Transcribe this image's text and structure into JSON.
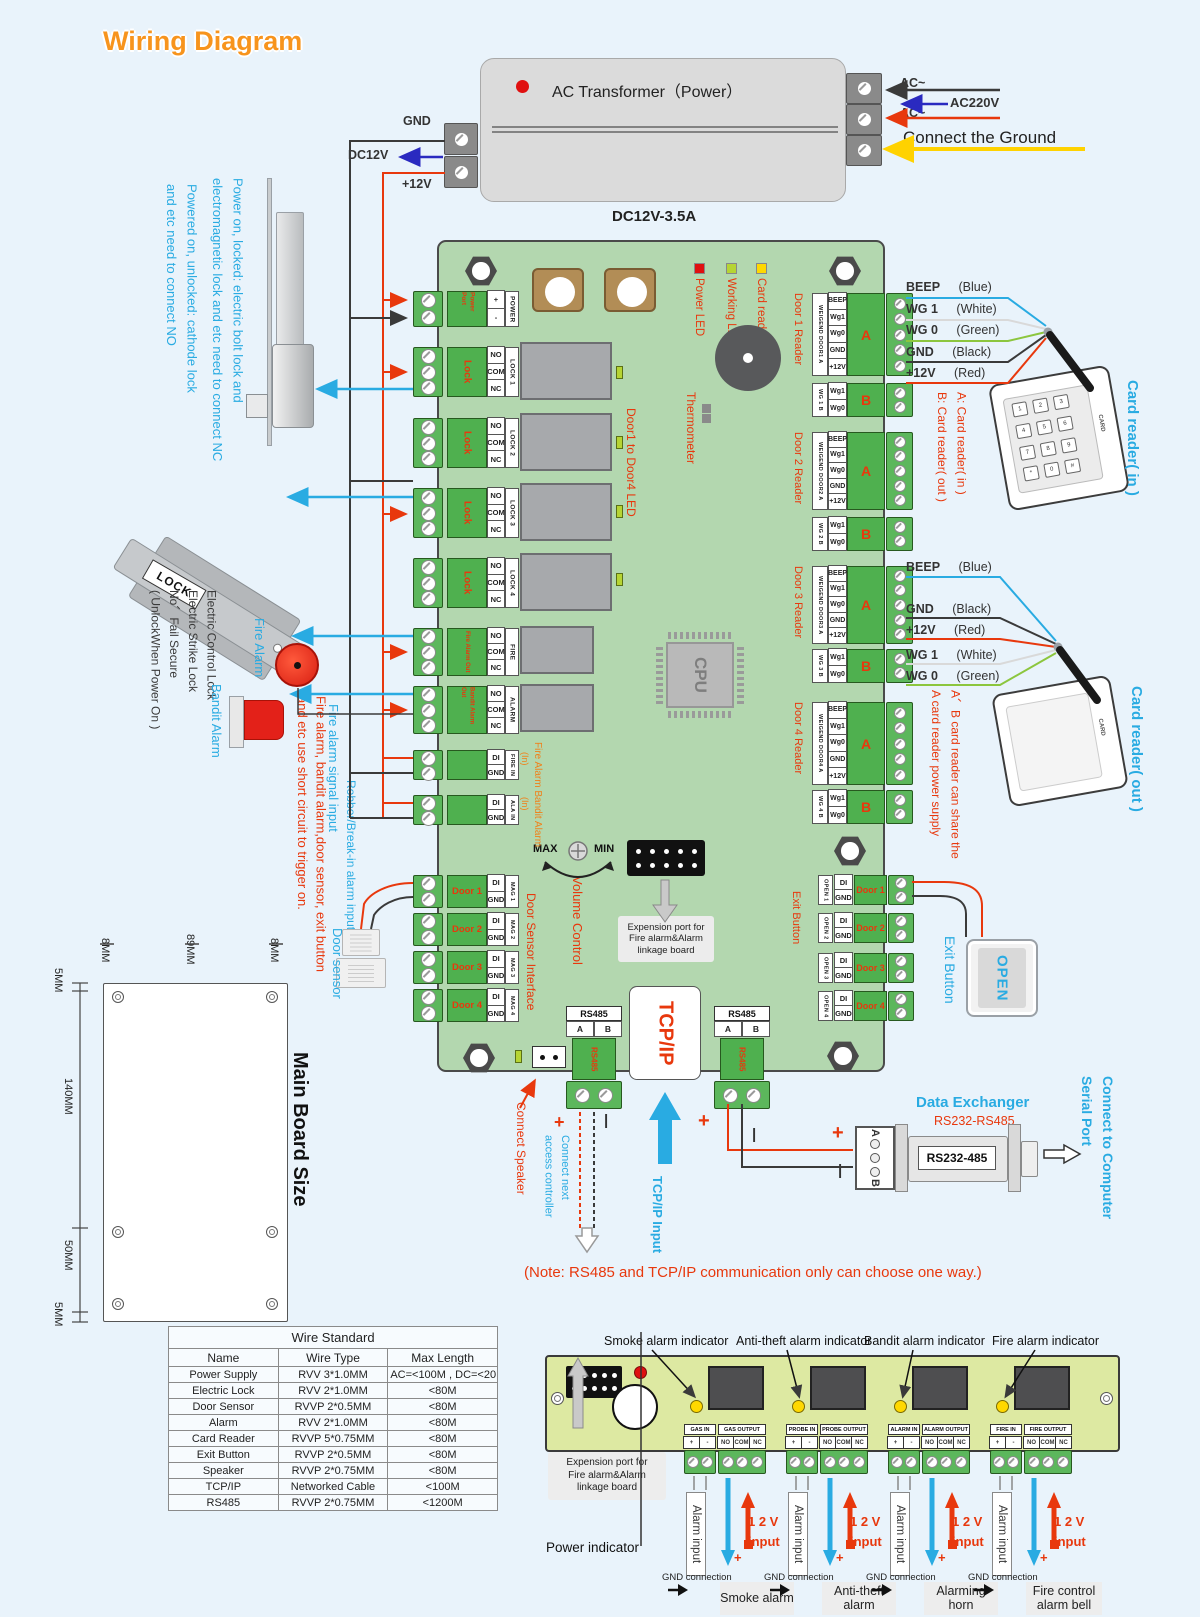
{
  "title": "Wiring Diagram",
  "transformer": {
    "label": "AC Transformer（Power）",
    "dc": "DC12V-3.5A",
    "gnd": "GND",
    "dc12v": "DC12V",
    "p12v": "+12V",
    "ac1": "AC~",
    "ac220": "AC220V",
    "ac2": "AC~",
    "ground": "Connect the Ground"
  },
  "left": {
    "nc_note": [
      "Power on, locked: electric bolt lock and",
      "electromagnetic lock and etc need to connect NC"
    ],
    "no_note": [
      "Powered on, unlocked: cathode lock",
      "and etc need to connect NO"
    ],
    "lock_word": "LOCK",
    "strike_note": [
      "Electric Control Lock",
      "Electric Strike Lock",
      "No、Fail Secure",
      "( UnlockWhen Power On )"
    ],
    "fire_alarm": "Fire Alarm",
    "bandit_alarm": "Bandit Alarm",
    "fire_signal": "Fire alarm signal input",
    "robber": "Robber/Break-in alarm input",
    "trigger_note": [
      "Fire alarm, bandit alarm,door sensor, exit button",
      "and etc use short circuit to trigger on."
    ],
    "door_sensor": "Door sensor"
  },
  "board": {
    "power": {
      "name": [
        "Power",
        "Port"
      ],
      "pins": [
        "+",
        "-"
      ],
      "tag": "POWER"
    },
    "nocomnc": [
      "NO",
      "COM",
      "NC"
    ],
    "digin": [
      "DI",
      "GND"
    ],
    "locks": [
      {
        "name": "Lock",
        "tag": "LOCK 1"
      },
      {
        "name": "Lock",
        "tag": "LOCK 2"
      },
      {
        "name": "Lock",
        "tag": "LOCK 3"
      },
      {
        "name": "Lock",
        "tag": "LOCK 4"
      }
    ],
    "fire_out": {
      "name": [
        "Fire Alarm",
        "Out"
      ],
      "tag": "FIRE"
    },
    "bandit_out": {
      "name": [
        "Bandit Alarm",
        "Out"
      ],
      "tag": "ALARM"
    },
    "fire_in_tag": "FIRE IN",
    "ala_in_tag": "ALA IN",
    "in_note": "(In)",
    "in_label": "Fire Alarm Bandit Alarm",
    "doors": [
      {
        "name": "Door 1",
        "tag": "MAG 1"
      },
      {
        "name": "Door 2",
        "tag": "MAG 2"
      },
      {
        "name": "Door 3",
        "tag": "MAG 3"
      },
      {
        "name": "Door 4",
        "tag": "MAG 4"
      }
    ],
    "door_iface": "Door Sensor Interface",
    "leds": [
      "Power LED",
      "Working LED",
      "Card reader LED"
    ],
    "thermometer": "Thermometer",
    "door_led": "Door1 to Door4 LED",
    "cpu": "CPU",
    "volume": {
      "max": "MAX",
      "min": "MIN",
      "label": "Volume Control"
    },
    "expansion": [
      "Expension port for",
      "Fire alarm&Alarm",
      "linkage board"
    ],
    "reader_a_pins": [
      "BEEP",
      "Wg1",
      "Wg0",
      "GND",
      "+12V"
    ],
    "reader_b_pins": [
      "Wg1",
      "Wg0"
    ],
    "readers": [
      {
        "name": "Door 1 Reader",
        "a_tag": "WEIGEND DOOR1 A",
        "b_tag": "WG 1 B",
        "a": "A",
        "b": "B"
      },
      {
        "name": "Door 2 Reader",
        "a_tag": "WEIGEND DOOR2 A",
        "b_tag": "WG 2 B",
        "a": "A",
        "b": "B"
      },
      {
        "name": "Door 3 Reader",
        "a_tag": "WEIGEND DOOR3 A",
        "b_tag": "WG 3 B",
        "a": "A",
        "b": "B"
      },
      {
        "name": "Door 4 Reader",
        "a_tag": "WEIGEND DOOR4 A",
        "b_tag": "WG 4 B",
        "a": "A",
        "b": "B"
      }
    ],
    "exit_label": "Exit Button",
    "exits": [
      {
        "tag": "OPEN 1",
        "name": "Door 1"
      },
      {
        "tag": "OPEN 2",
        "name": "Door 2"
      },
      {
        "tag": "OPEN 3",
        "name": "Door 3"
      },
      {
        "tag": "OPEN 4",
        "name": "Door 4"
      }
    ],
    "rs485": {
      "title": "RS485",
      "a": "A",
      "b": "B",
      "vert": "RS485"
    },
    "tcpip": "TCP/IP"
  },
  "right": {
    "wires1": [
      {
        "n": "BEEP",
        "c": "(Blue)"
      },
      {
        "n": "WG 1",
        "c": "(White)"
      },
      {
        "n": "WG 0",
        "c": "(Green)"
      },
      {
        "n": "GND",
        "c": "(Black)"
      },
      {
        "n": "+12V",
        "c": "(Red)"
      }
    ],
    "wires2": [
      {
        "n": "BEEP",
        "c": "(Blue)"
      },
      {
        "n": "GND",
        "c": "(Black)"
      },
      {
        "n": "+12V",
        "c": "(Red)"
      },
      {
        "n": "WG 1",
        "c": "(White)"
      },
      {
        "n": "WG 0",
        "c": "(Green)"
      }
    ],
    "ab_note": [
      "A: Card reader( in )",
      "B: Card reader( out )"
    ],
    "share_note": [
      "A、B card reader can share the",
      "A card reader power supply"
    ],
    "reader_in": "Card reader( in )",
    "reader_out": "Card reader( out )",
    "card": "CARD",
    "keys": [
      "1",
      "2",
      "3",
      "4",
      "5",
      "6",
      "7",
      "8",
      "9",
      "*",
      "0",
      "#"
    ],
    "open": "OPEN",
    "exit_button": "Exit Button"
  },
  "mid": {
    "connect_speaker": "Connect Speaker",
    "connect_next": [
      "Connect next",
      "access controller"
    ],
    "tcpip_input": "TCP/IP Input",
    "plus": "+",
    "minus": "|",
    "note": "(Note: RS485 and TCP/IP communication only can choose one way.)",
    "exchanger": {
      "title": "Data Exchanger",
      "sub": "RS232-RS485",
      "label": "RS232-485",
      "a": "A",
      "b": "B"
    },
    "connect_computer": [
      "Connect to Computer",
      "Serial Port"
    ]
  },
  "size": {
    "label": "Main Board Size",
    "top": [
      "8MM",
      "89MM",
      "8MM"
    ],
    "left": [
      "5MM",
      "140MM",
      "50MM",
      "5MM"
    ]
  },
  "table": {
    "title": "Wire Standard",
    "headers": [
      "Name",
      "Wire Type",
      "Max Length"
    ],
    "rows": [
      [
        "Power Supply",
        "RVV 3*1.0MM",
        "AC=<100M , DC=<20M"
      ],
      [
        "Electric Lock",
        "RVV 2*1.0MM",
        "<80M"
      ],
      [
        "Door Sensor",
        "RVVP 2*0.5MM",
        "<80M"
      ],
      [
        "Alarm",
        "RVV 2*1.0MM",
        "<80M"
      ],
      [
        "Card Reader",
        "RVVP 5*0.75MM",
        "<80M"
      ],
      [
        "Exit Button",
        "RVVP 2*0.5MM",
        "<80M"
      ],
      [
        "Speaker",
        "RVVP 2*0.75MM",
        "<80M"
      ],
      [
        "TCP/IP",
        "Networked Cable",
        "<100M"
      ],
      [
        "RS485",
        "RVVP 2*0.75MM",
        "<1200M"
      ]
    ]
  },
  "linkage": {
    "indicators": [
      "Smoke alarm indicator",
      "Anti-theft alarm indicator",
      "Bandit alarm indicator",
      "Fire alarm indicator"
    ],
    "in_pins": [
      "+",
      "-"
    ],
    "out_pins": [
      "NO",
      "COM",
      "NC"
    ],
    "channels": [
      {
        "in": "GAS IN",
        "out": "GAS OUTPUT",
        "device": "Smoke alarm"
      },
      {
        "in": "PROBE IN",
        "out": "PROBE OUTPUT",
        "device": "Anti-theft alarm"
      },
      {
        "in": "ALARM IN",
        "out": "ALARM OUTPUT",
        "device": "Alarming horn"
      },
      {
        "in": "FIRE IN",
        "out": "FIRE OUTPUT",
        "device": "Fire control alarm bell"
      }
    ],
    "expansion": [
      "Expension port for",
      "Fire alarm&Alarm",
      "linkage board"
    ],
    "power_indicator": "Power indicator",
    "gnd": "GND connection",
    "alarm_input": "Alarm input",
    "v12": "1 2 V",
    "input": "input"
  }
}
